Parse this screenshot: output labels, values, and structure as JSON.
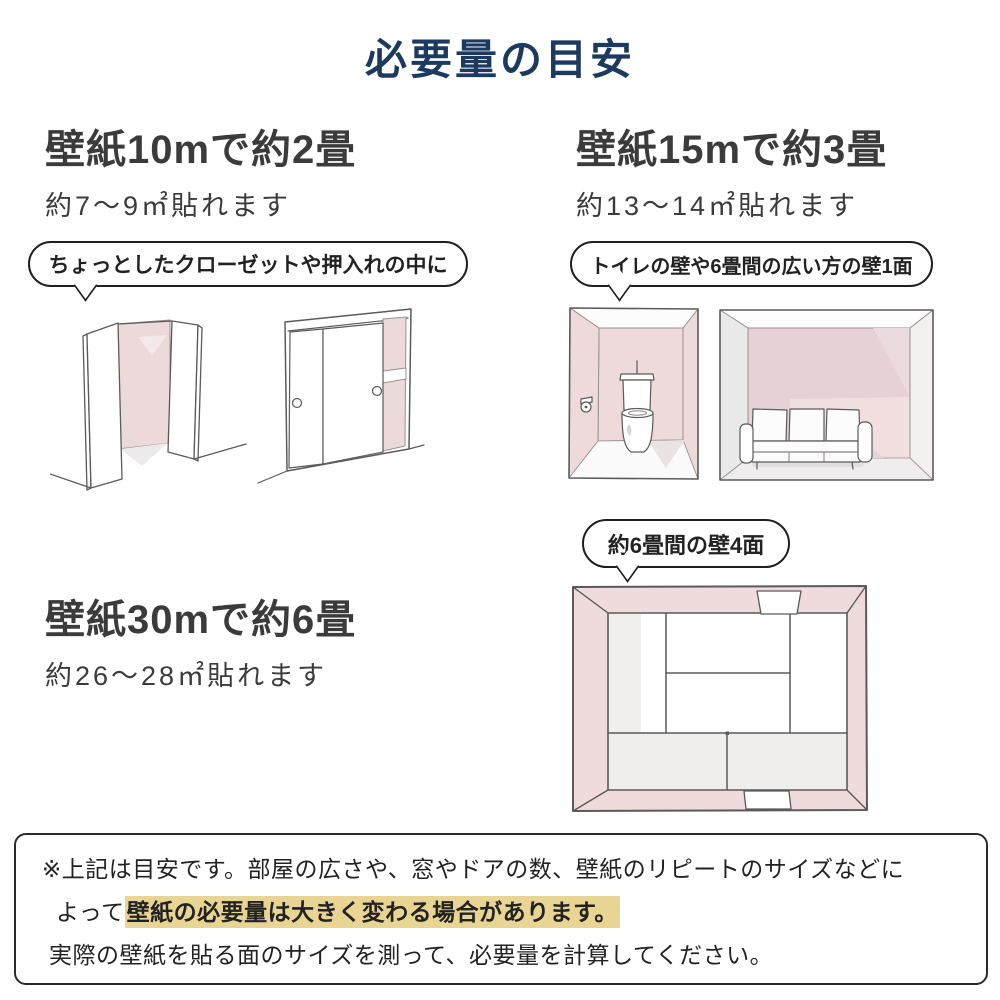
{
  "title": "必要量の目安",
  "sections": {
    "s10m": {
      "heading": "壁紙10mで約2畳",
      "subtitle": "約7～9㎡貼れます",
      "bubble": "ちょっとしたクローゼットや押入れの中に"
    },
    "s15m": {
      "heading": "壁紙15mで約3畳",
      "subtitle": "約13～14㎡貼れます",
      "bubble": "トイレの壁や6畳間の広い方の壁1面"
    },
    "s30m": {
      "heading": "壁紙30mで約6畳",
      "subtitle": "約26～28㎡貼れます",
      "bubble": "約6畳間の壁4面"
    }
  },
  "note": {
    "line1": "※上記は目安です。部屋の広さや、窓やドアの数、壁紙のリピートのサイズなどに",
    "line2_prefix": "よって",
    "line2_highlight": "壁紙の必要量は大きく変わる場合があります。",
    "line3": "実際の壁紙を貼る面のサイズを測って、必要量を計算してください。"
  },
  "illustrations": [
    "open-closet-sketch",
    "sliding-door-closet-sketch",
    "toilet-room-sketch",
    "living-room-sofa-sketch",
    "six-tatami-room-top-view-sketch"
  ],
  "colors": {
    "title_navy": "#1c3a5f",
    "heading_text": "#3b3b3b",
    "note_highlight_bg": "#e9d593",
    "wallpaper_pink": "#eedada",
    "wallpaper_pink_dark": "#e6d1d4",
    "sketch_line": "#5a5a5a"
  }
}
